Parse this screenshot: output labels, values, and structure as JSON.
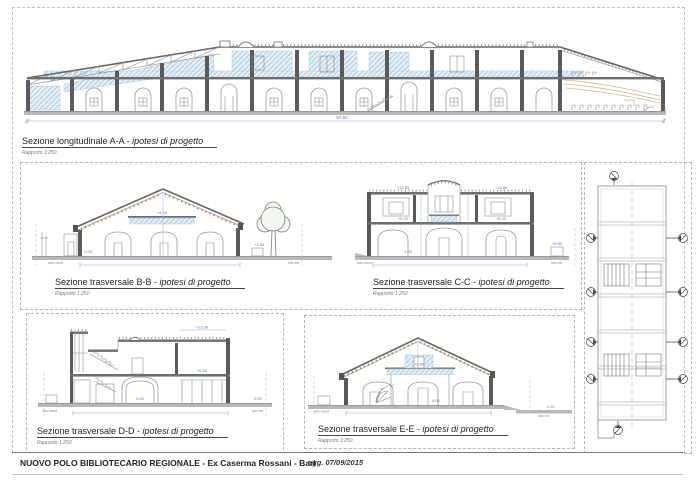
{
  "common": {
    "sep": " - "
  },
  "sections": {
    "aa": {
      "title": "Sezione longitudinale A-A",
      "subtitle": "ipotesi di progetto",
      "scale": "Rapporto 1:250",
      "dim_total": "97.80"
    },
    "bb": {
      "title": "Sezione trasversale B-B",
      "subtitle": "ipotesi di progetto",
      "scale": "Rapporto 1:250",
      "lev_mezz": "+4.20",
      "lev_ground": "0.00",
      "lev_ext": "+1.80",
      "side_left": "lato ovest",
      "side_right": "lato est"
    },
    "cc": {
      "title": "Sezione trasversale C-C",
      "subtitle": "ipotesi di progetto",
      "scale": "Rapporto 1:250",
      "lev_parapet_left": "+12.05",
      "lev_parapet_right": "+12.80",
      "lev_floor_left": "+5.20",
      "lev_floor_right": "+5.20",
      "lev_ground": "0.00",
      "lev_ext": "+0.80",
      "side_left": "lato ovest",
      "side_right": "lato est"
    },
    "dd": {
      "title": "Sezione trasversale D-D",
      "subtitle": "ipotesi di progetto",
      "scale": "Rapporto 1:250",
      "lev_top": "+13.30",
      "lev_floor": "+6.50",
      "lev_ground": "0.00",
      "lev_ext": "0.00",
      "side_left": "lato ovest",
      "side_right": "lato est"
    },
    "ee": {
      "title": "Sezione trasversale E-E",
      "subtitle": "ipotesi di progetto",
      "scale": "Rapporto 1:250",
      "lev_mezz": "+3.50",
      "lev_ground": "0.00",
      "lev_ext": "-1.20",
      "side_left": "lato ovest",
      "side_right": "lato est"
    }
  },
  "footer": {
    "title": "NUOVO POLO BIBLIOTECARIO REGIONALE - Ex Caserma Rossani - Bari",
    "date": "agg. 07/09/2015"
  },
  "colors": {
    "hatch_blue": "#9dbdd6",
    "hatch_bg": "#e3eef6",
    "structure_gray": "#5a5a5a",
    "roof_orange": "#c0713d",
    "dim_blue": "#5577aa",
    "ground_gray": "#b8b8b8"
  }
}
